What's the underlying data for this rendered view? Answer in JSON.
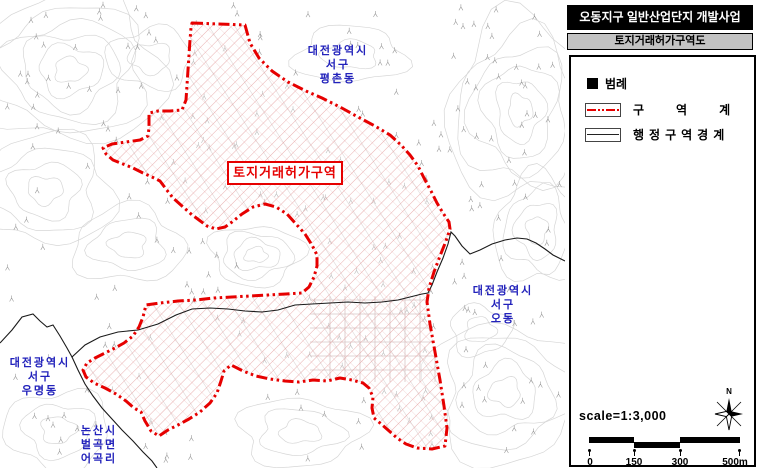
{
  "map": {
    "zone_label": "토지거래허가구역",
    "region_labels": [
      {
        "name": "pyeongchon",
        "lines": [
          "대전광역시",
          "서구",
          "평촌동"
        ]
      },
      {
        "name": "odong",
        "lines": [
          "대전광역시",
          "서구",
          "오동"
        ]
      },
      {
        "name": "umyeong",
        "lines": [
          "대전광역시",
          "서구",
          "우명동"
        ]
      },
      {
        "name": "eogok",
        "lines": [
          "논산시",
          "벌곡면",
          "어곡리"
        ]
      }
    ],
    "colors": {
      "zone_boundary": "#e60000",
      "zone_hatch": "#e09090",
      "region_label_blue": "#2222bb",
      "admin_boundary": "#1a1a1a",
      "contour_gray": "#d6d6d6"
    }
  },
  "panel": {
    "title": "오동지구 일반산업단지 개발사업",
    "subtitle": "토지거래허가구역도",
    "legend_title": "범례",
    "legend_items": [
      {
        "type": "zone-boundary",
        "label": "구역계"
      },
      {
        "type": "admin-boundary",
        "label": "행정구역경계"
      }
    ],
    "scale_text": "scale=1:3,000",
    "scale_ticks": [
      "0",
      "150",
      "300",
      "500m"
    ],
    "north_label": "N"
  }
}
